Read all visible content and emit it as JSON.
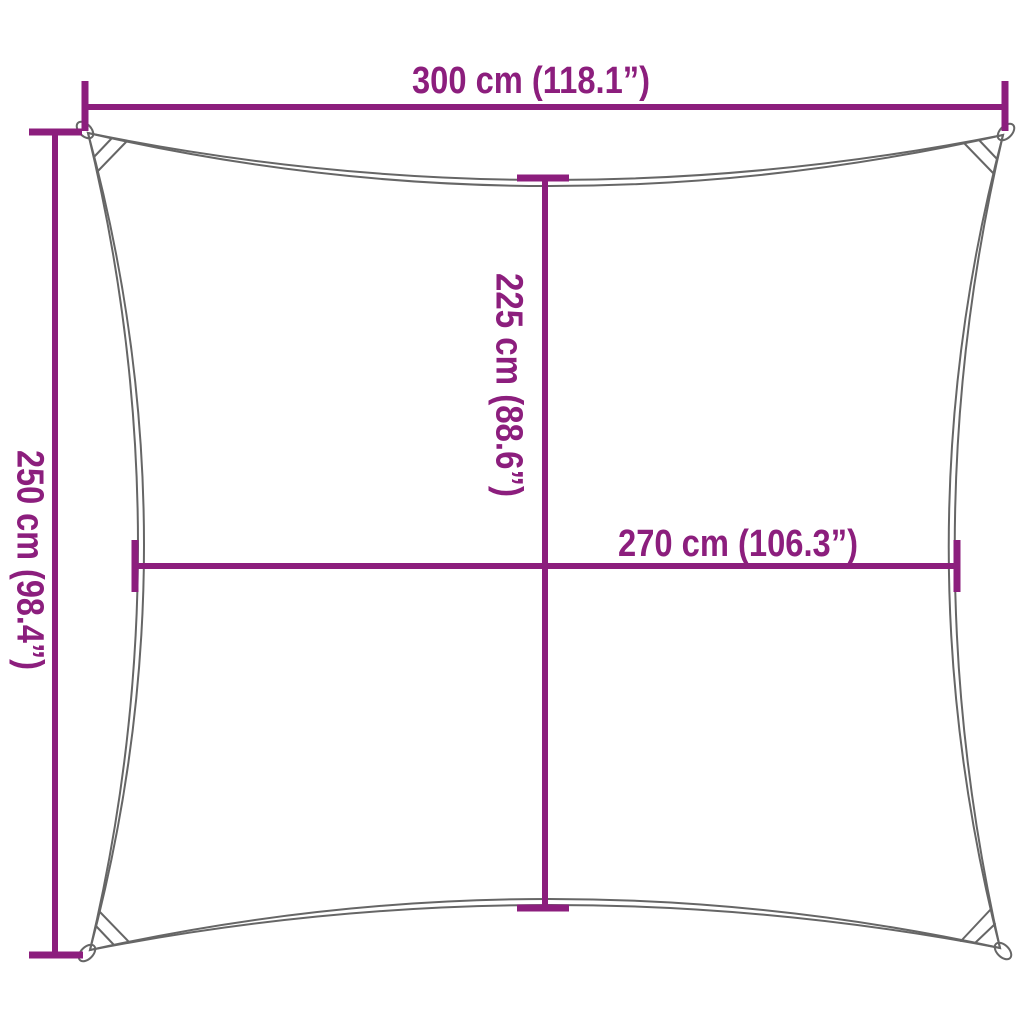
{
  "diagram": {
    "colors": {
      "dimension_line": "#8c1e7d",
      "sail_outline": "#666666",
      "background": "#ffffff"
    },
    "dimensions": {
      "top_width": {
        "label": "300 cm (118.1”)",
        "cm": 300,
        "inches": 118.1
      },
      "left_height": {
        "label": "250 cm (98.4”)",
        "cm": 250,
        "inches": 98.4
      },
      "center_height": {
        "label": "225 cm (88.6”)",
        "cm": 225,
        "inches": 88.6
      },
      "center_width": {
        "label": "270 cm (106.3”)",
        "cm": 270,
        "inches": 106.3
      }
    }
  }
}
